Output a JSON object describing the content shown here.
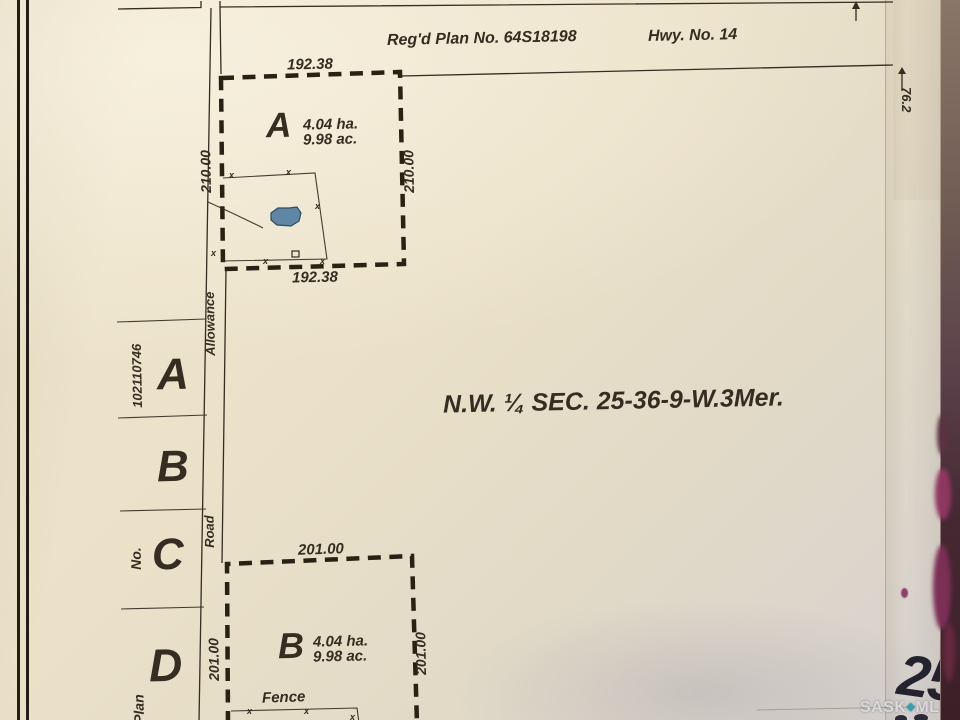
{
  "header": {
    "regd_plan": "Reg'd Plan No. 64S18198",
    "highway": "Hwy. No. 14",
    "offset_dimension": "76.2"
  },
  "section_label": "N.W. ¼ SEC. 25-36-9-W.3Mer.",
  "road_allowance": {
    "word_top": "Allowance",
    "word_bottom": "Road"
  },
  "left_column": {
    "plan_word": "Plan",
    "no_word": "No.",
    "plan_number": "102110746",
    "lots": [
      "A",
      "B",
      "C",
      "D"
    ]
  },
  "parcel_a": {
    "name": "A",
    "area_ha": "4.04 ha.",
    "area_ac": "9.98 ac.",
    "dim_top": "192.38",
    "dim_bottom": "192.38",
    "dim_left": "210.00",
    "dim_right": "210.00"
  },
  "parcel_b": {
    "name": "B",
    "area_ha": "4.04 ha.",
    "area_ac": "9.98 ac.",
    "dim_top": "201.00",
    "dim_left": "201.00",
    "dim_right": "201.00"
  },
  "fence_label": "Fence",
  "symbols": {
    "fence_mark": "x"
  },
  "watermark": {
    "brand_sask": "SASK",
    "brand_mls": "MLS",
    "diamond": "◆",
    "registered": "®",
    "page_number": "25"
  },
  "colors": {
    "ink": "#352c22",
    "dash": "#2a2115",
    "pond_fill": "#5d87a4",
    "pond_stroke": "#2e4c63",
    "teal": "#2ba4b4",
    "watermark_text": "#d9d9dc",
    "page_number": "#23232f",
    "magenta": "#8e3760"
  }
}
